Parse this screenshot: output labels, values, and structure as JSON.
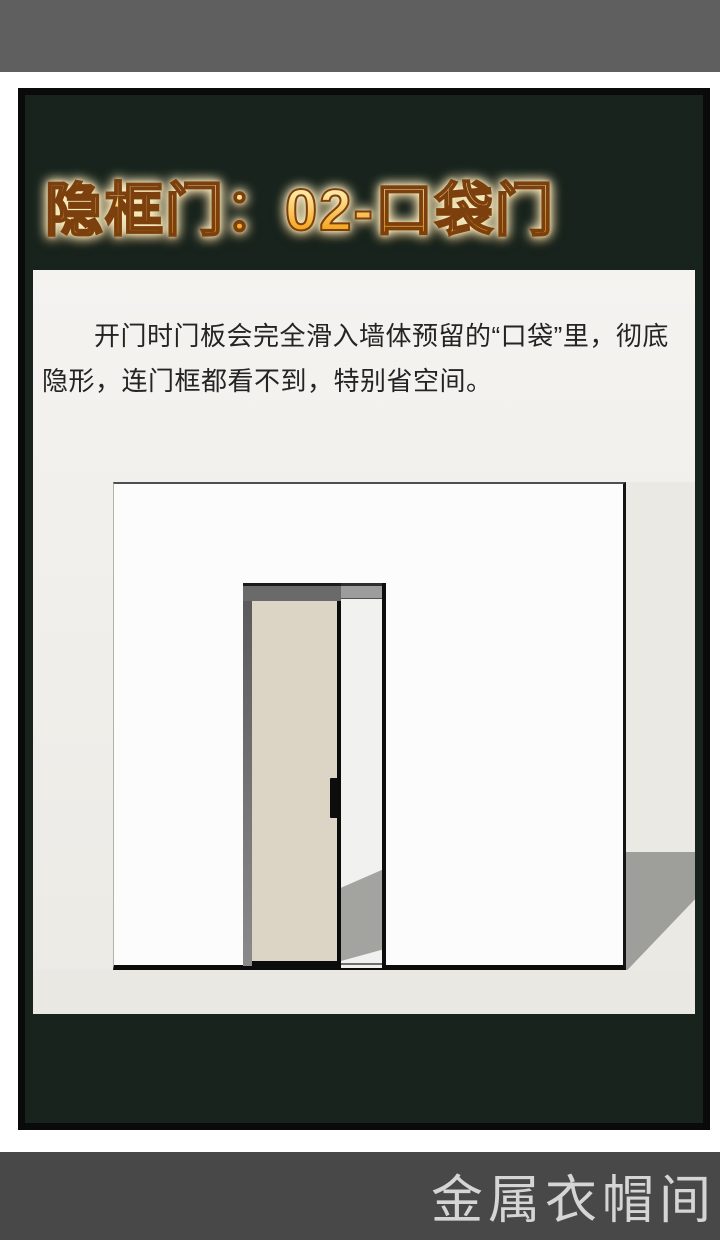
{
  "header": {
    "title": "隐框门：02-口袋门"
  },
  "description": {
    "text": "开门时门板会完全滑入墙体预留的“口袋”里，彻底隐形，连门框都看不到，特别省空间。"
  },
  "watermark": {
    "text": "金属衣帽间"
  },
  "illustration": {
    "subject": "pocket-door-half-open-3d-render"
  },
  "colors": {
    "top_bar": "#5f5f5f",
    "bottom_bar": "#484848",
    "panel_green": "#17231c",
    "frame_border": "#0a0a0a",
    "title_orange": "#f6a41f",
    "title_outline": "#7c3f0e",
    "card_bg": "#f2f1ed",
    "door_beige": "#dcd5c6",
    "shadow_gray": "#9e9e9a",
    "text_dark": "#242424",
    "watermark_gray": "#d5d5d5"
  }
}
